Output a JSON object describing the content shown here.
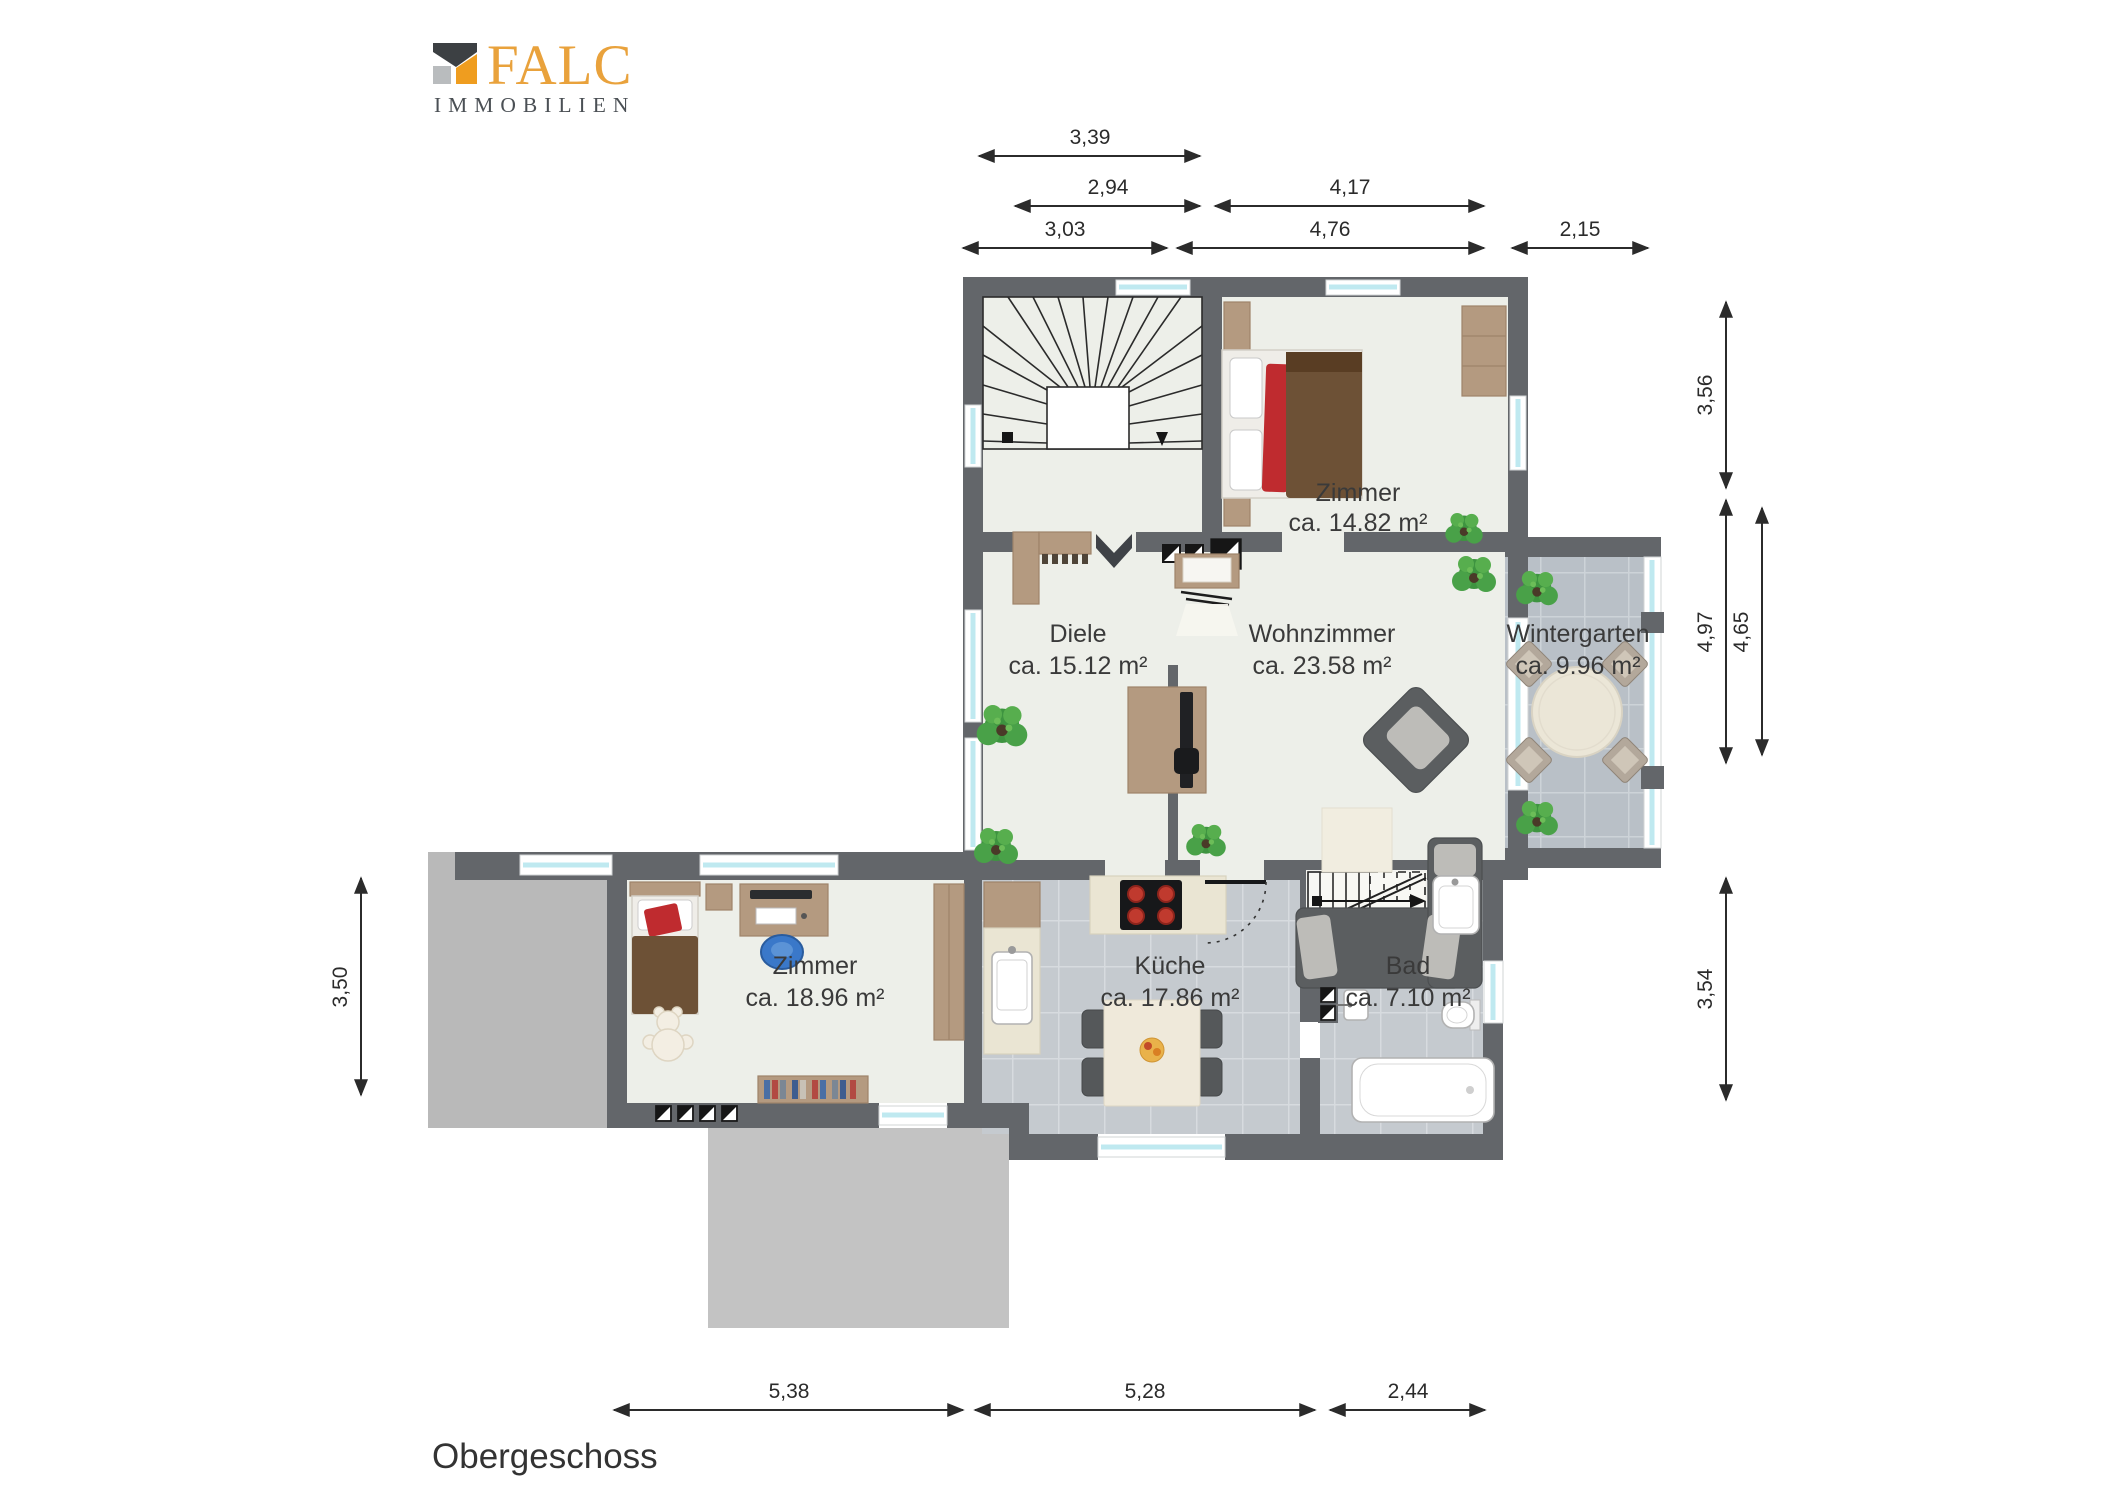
{
  "brand": {
    "name": "FALC",
    "subtitle": "IMMOBILIEN"
  },
  "floor": {
    "label": "Obergeschoss"
  },
  "rooms": [
    {
      "name": "Zimmer",
      "area": "ca. 14.82 m²"
    },
    {
      "name": "Diele",
      "area": "ca. 15.12 m²"
    },
    {
      "name": "Wohnzimmer",
      "area": "ca. 23.58 m²"
    },
    {
      "name": "Wintergarten",
      "area": "ca. 9.96 m²"
    },
    {
      "name": "Zimmer",
      "area": "ca. 18.96 m²"
    },
    {
      "name": "Küche",
      "area": "ca. 17.86 m²"
    },
    {
      "name": "Bad",
      "area": "ca. 7.10 m²"
    }
  ],
  "dimensions": {
    "top": [
      "3,39",
      "2,94",
      "4,17",
      "3,03",
      "4,76",
      "2,15"
    ],
    "right": [
      "3,56",
      "4,97",
      "4,65",
      "3,54"
    ],
    "left": [
      "3,50"
    ],
    "bottom": [
      "5,38",
      "5,28",
      "2,44"
    ]
  },
  "colors": {
    "wall": "#63666a",
    "floor": "#edefe9",
    "roof": "#b9b9b9",
    "window": "#bfe9f0",
    "wood": "#b49a80",
    "sofa": "#5b5e60",
    "ink": "#3a3a3a",
    "brand_orange": "#e9a23c",
    "brand_dark": "#4b5055",
    "accent_red": "#bf2b2f",
    "bed_brown": "#6d5136",
    "plant_green": "#459a43"
  }
}
